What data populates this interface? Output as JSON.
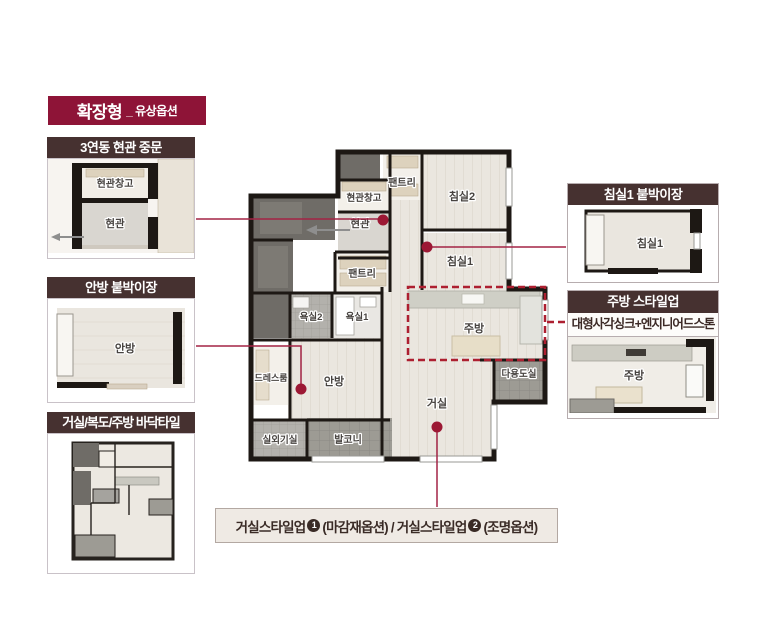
{
  "title_badge": {
    "main": "확장형",
    "sub": "_ 유상옵션"
  },
  "callouts": {
    "entrance_door": {
      "header": "3연동 현관 중문",
      "storage_label": "현관창고",
      "entrance_label": "현관"
    },
    "master_closet": {
      "header": "안방 붙박이장",
      "room_label": "안방"
    },
    "floor_tile": {
      "header": "거실/복도/주방 바닥타일"
    },
    "bed1_closet": {
      "header": "침실1 붙박이장",
      "room_label": "침실1"
    },
    "kitchen_styleup": {
      "header": "주방 스타일업",
      "subtitle": "대형사각싱크+엔지니어드스톤",
      "room_label": "주방"
    }
  },
  "floorplan": {
    "rooms": {
      "pantry_top": "팬트리",
      "bedroom2": "침실2",
      "entrance_storage": "현관창고",
      "entrance": "현관",
      "bedroom1": "침실1",
      "pantry_mid": "팬트리",
      "bath2": "욕실2",
      "bath1": "욕실1",
      "kitchen": "주방",
      "master_bedroom": "안방",
      "dress_room": "드레스룸",
      "living_room": "거실",
      "utility_room": "다용도실",
      "outdoor_unit": "실외기실",
      "balcony": "발코니"
    }
  },
  "bottom_note": {
    "part1": "거실스타일업",
    "num1": "1",
    "part2": "(마감재옵션) / 거실스타일업",
    "num2": "2",
    "part3": "(조명옵션)"
  },
  "colors": {
    "badge_maroon": "#8e1437",
    "callout_header_brown": "#463130",
    "connector_red": "#a32345",
    "dashed_red": "#ad1f30",
    "wall_black": "#1d1814",
    "floor_light": "#eae6df",
    "tile_gray": "#9d9b94"
  }
}
